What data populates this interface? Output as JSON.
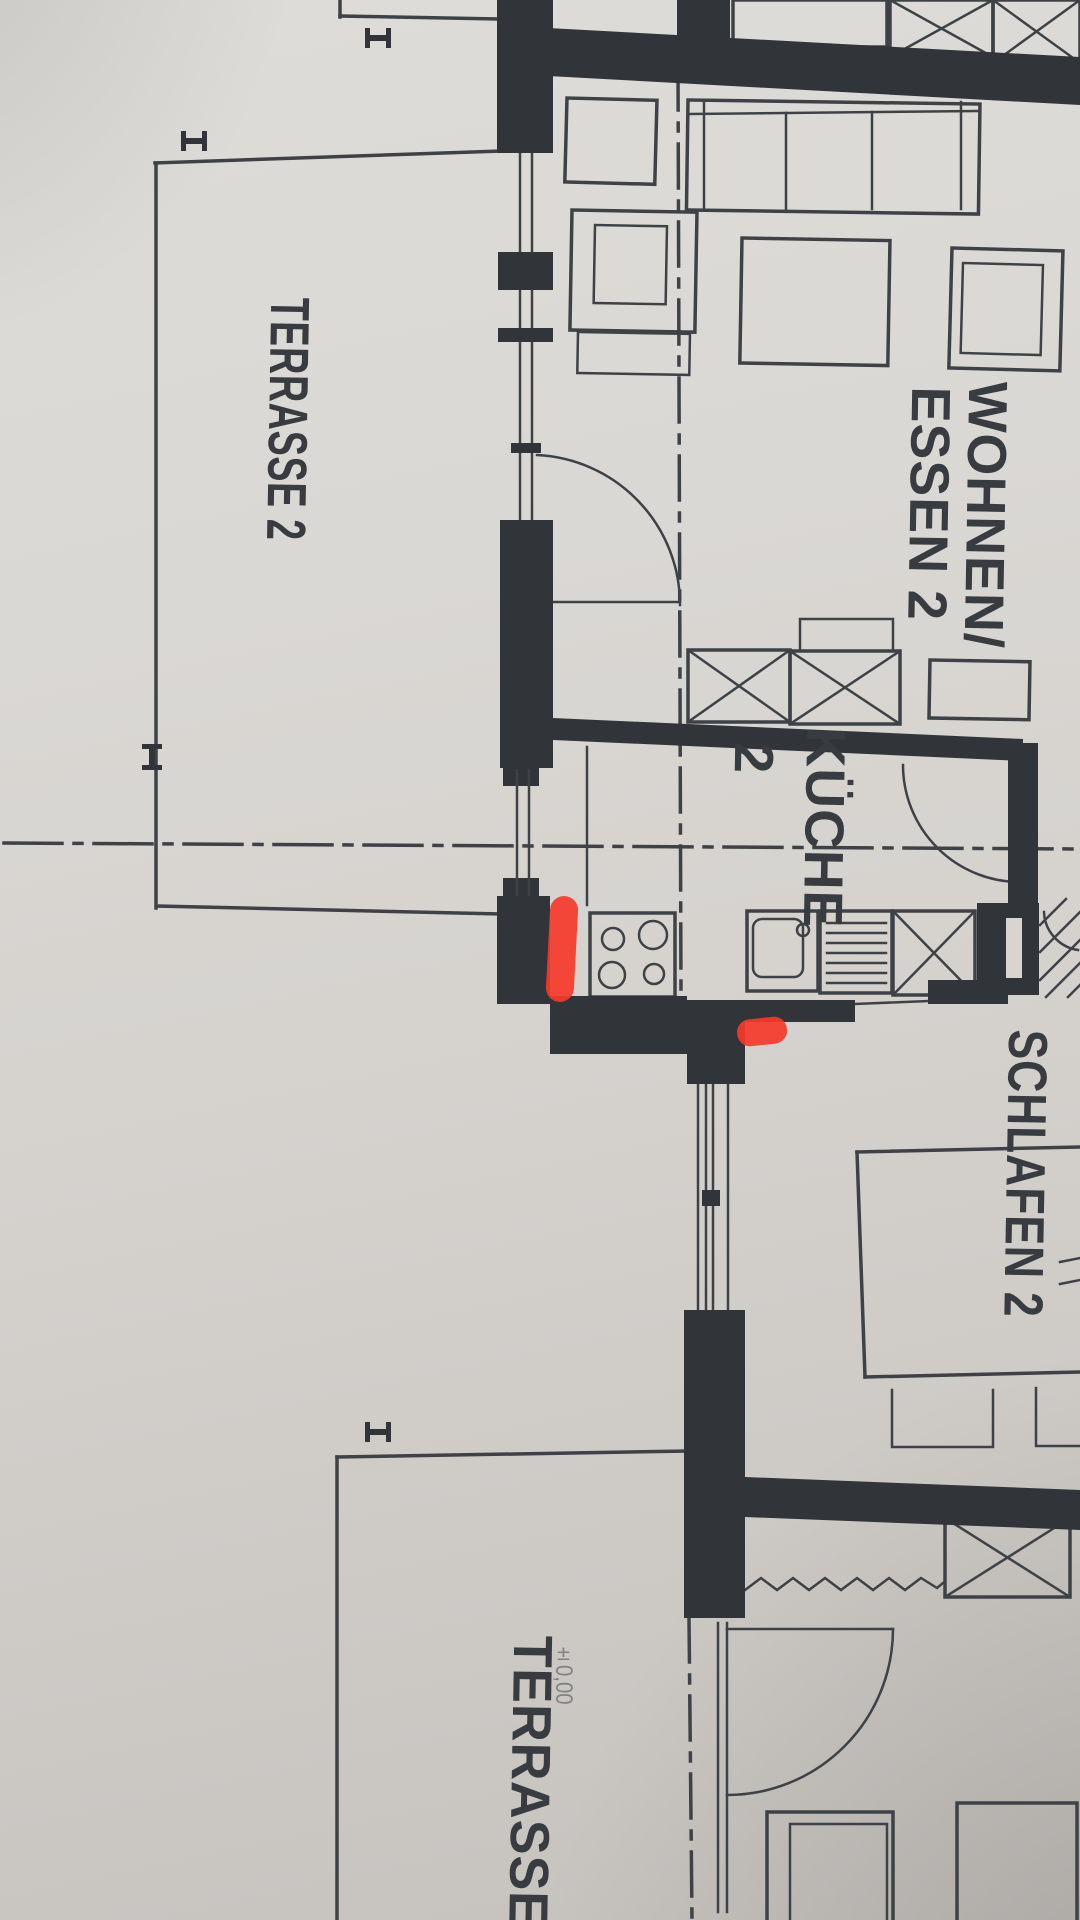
{
  "plan": {
    "labels": {
      "wohnen": "WOHNEN/",
      "essen": "ESSEN 2",
      "kueche": "KÜCHE",
      "kueche_number": "2",
      "terrasse_upper": "TERRASSE 2",
      "schlafen": "SCHLAFEN 2",
      "terrasse_lower": "TERRASSE",
      "level_mark": "±0,00"
    },
    "colors": {
      "paper": "#d8d5d1",
      "ink": "#3e4247",
      "wall": "#31353a",
      "marker_red": "#f5392b"
    },
    "annotations": {
      "marker_count": 2
    }
  }
}
